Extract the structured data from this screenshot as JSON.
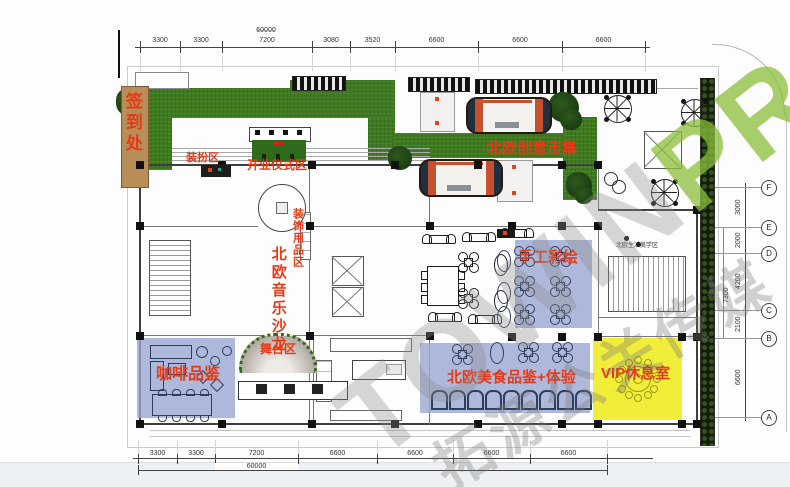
{
  "watermark": {
    "latin_gray": "TOWIN",
    "latin_green": "PR",
    "chinese": "拓源公关传媒"
  },
  "colors": {
    "label_red": "#e63a17",
    "turf_green": "#3f7a21",
    "zone_blue": "#9aa6d2",
    "zone_yellow": "#f1ee39",
    "wood_tan": "#b78d58",
    "furniture_navy": "#2e3f5c",
    "furniture_black": "#1c1c1c",
    "backdrop_green": "#2f6b1d",
    "truck_orange": "#c8502e",
    "truck_navy": "#203040",
    "watermark_green": "#8bbf39"
  },
  "zones": [
    {
      "id": "sign-in",
      "label": "签到处"
    },
    {
      "id": "dress-up",
      "label": "装扮区"
    },
    {
      "id": "opening-ceremony",
      "label": "开业仪式区"
    },
    {
      "id": "creative-market",
      "label": "北欧创意市集"
    },
    {
      "id": "decor-supplies",
      "label": "装饰用品区"
    },
    {
      "id": "music-salon",
      "label": "北欧音乐沙龙"
    },
    {
      "id": "hand-painting",
      "label": "手工彩绘"
    },
    {
      "id": "stage",
      "label": "舞台区"
    },
    {
      "id": "coffee-tasting",
      "label": "咖啡品鉴"
    },
    {
      "id": "food-tasting",
      "label": "北欧美食品鉴+体验"
    },
    {
      "id": "vip-lounge",
      "label": "VIP休息室"
    },
    {
      "id": "lifestyle",
      "label": "北欧生活美学区"
    }
  ],
  "dimensions": {
    "top": {
      "segments": [
        "3300",
        "3300",
        "7200",
        "3080",
        "3520",
        "6600",
        "6600",
        "6600"
      ],
      "total": "60000"
    },
    "bottom": {
      "segments": [
        "3300",
        "3300",
        "7200",
        "6600",
        "6600",
        "6600",
        "6600"
      ],
      "total": "60000"
    },
    "right": {
      "bubbles": [
        "F",
        "E",
        "D",
        "C",
        "B",
        "A"
      ],
      "segments": [
        "3000",
        "2000",
        "4200",
        "2100",
        "6600"
      ],
      "extra": "7300"
    }
  }
}
